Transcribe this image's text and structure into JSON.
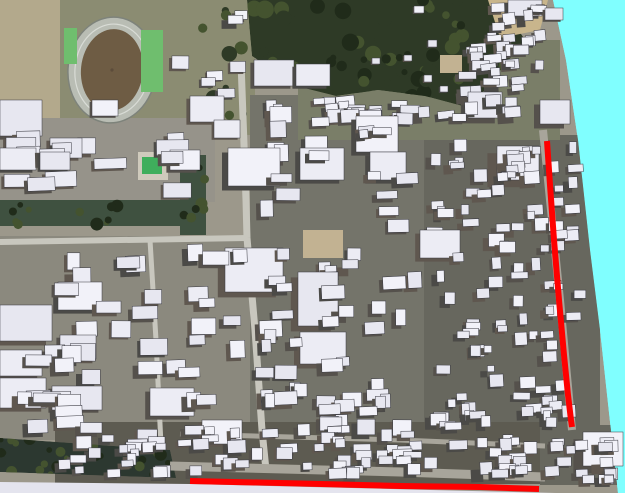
{
  "scene": {
    "width": 625,
    "height": 493,
    "seed": 11,
    "colors": {
      "sky": "#80FFFF",
      "groundBase": "#9C988B",
      "tanZone": "#B3A98C",
      "parkOlive": "#8B8C72",
      "leftTopGround": "#96938A",
      "leftGround": "#8B897E",
      "denseGround": "#74746A",
      "denseGround2": "#67675E",
      "neGround": "#7A7E68",
      "bottomGround": "#5D5B51",
      "forest": "#2E3A26",
      "forestLight": "#44532F",
      "forestDark": "#202B1A",
      "canal": "#3F5140",
      "treeBand": "#2C3830",
      "road": "#C8C7BE",
      "roadDark": "#A8A59B",
      "trackGray": "#B9BDB4",
      "trackEdge": "#7E837B",
      "laneWhite": "#D9DCD6",
      "infield": "#6E5C44",
      "infieldDot": "#5C4C3B",
      "courtGreen": "#6FBE6E",
      "poolGreen": "#3FAE5C",
      "poolDeck": "#CFCABC",
      "tanLot": "#C2B292",
      "tanCorner": "#C8B58C",
      "skirt": "#E4E4EE",
      "outline": "#383840",
      "roofTints": [
        "#ECECF4",
        "#E7E7F0",
        "#F2F2F9"
      ],
      "sideTints": [
        "#55514C",
        "#4B4A47",
        "#5F574F"
      ]
    },
    "terrain": {
      "polygon": [
        [
          0,
          0
        ],
        [
          553,
          0
        ],
        [
          566,
          60
        ],
        [
          578,
          140
        ],
        [
          590,
          250
        ],
        [
          600,
          330
        ],
        [
          612,
          440
        ],
        [
          618,
          493
        ],
        [
          0,
          493
        ]
      ]
    },
    "skirt": {
      "polygon": [
        [
          0,
          482
        ],
        [
          190,
          484
        ],
        [
          430,
          490
        ],
        [
          556,
          493
        ],
        [
          0,
          493
        ]
      ]
    },
    "grounds": [
      [
        0,
        0,
        66,
        140,
        "tanZone"
      ],
      [
        60,
        0,
        195,
        135,
        "parkOlive"
      ],
      [
        0,
        118,
        215,
        84,
        "leftTopGround"
      ],
      [
        0,
        236,
        252,
        204,
        "leftGround"
      ],
      [
        250,
        95,
        175,
        350,
        "denseGround"
      ],
      [
        424,
        135,
        176,
        300,
        "denseGround2"
      ],
      [
        298,
        40,
        262,
        100,
        "neGround"
      ],
      [
        55,
        422,
        500,
        62,
        "bottomGround"
      ],
      [
        540,
        425,
        85,
        60,
        "denseGround2"
      ]
    ],
    "forest": {
      "polygon": [
        [
          247,
          0
        ],
        [
          498,
          0
        ],
        [
          525,
          40
        ],
        [
          470,
          108
        ],
        [
          425,
          96
        ],
        [
          378,
          90
        ],
        [
          336,
          96
        ],
        [
          296,
          86
        ],
        [
          252,
          56
        ]
      ],
      "scatter": 70
    },
    "canal": {
      "rects": [
        [
          0,
          200,
          205,
          26
        ],
        [
          180,
          155,
          26,
          80
        ]
      ],
      "scatter": 20
    },
    "park_trees": {
      "region": [
        165,
        0,
        85,
        125
      ],
      "scatter": 10
    },
    "stadium": {
      "cx": 112,
      "cy": 70,
      "rx": 44,
      "ry": 53,
      "rotation": 6
    },
    "courts": [
      [
        141,
        30,
        22,
        62
      ],
      [
        64,
        28,
        13,
        36
      ]
    ],
    "pool": {
      "deck": [
        138,
        152,
        30,
        28
      ],
      "water": [
        142,
        157,
        20,
        17
      ]
    },
    "tan_lots": [
      [
        303,
        230,
        40,
        28
      ],
      [
        440,
        55,
        22,
        18
      ]
    ],
    "tan_corner": {
      "polygon": [
        [
          488,
          0
        ],
        [
          548,
          0
        ],
        [
          540,
          30
        ],
        [
          500,
          38
        ]
      ]
    },
    "tree_band": {
      "polygon": [
        [
          0,
          438
        ],
        [
          170,
          450
        ],
        [
          176,
          478
        ],
        [
          0,
          472
        ]
      ],
      "scatter": 26
    },
    "roads": [
      {
        "points": [
          [
            241,
            62
          ],
          [
            246,
            200
          ],
          [
            247,
            238
          ]
        ],
        "width": 7,
        "color": "road"
      },
      {
        "points": [
          [
            0,
            242
          ],
          [
            247,
            238
          ]
        ],
        "width": 6,
        "color": "road"
      },
      {
        "points": [
          [
            247,
            238
          ],
          [
            255,
            330
          ],
          [
            262,
            430
          ],
          [
            266,
            470
          ]
        ],
        "width": 7,
        "color": "road"
      },
      {
        "points": [
          [
            150,
            240
          ],
          [
            156,
            340
          ],
          [
            161,
            445
          ]
        ],
        "width": 5,
        "color": "road"
      },
      {
        "points": [
          [
            180,
            434
          ],
          [
            400,
            440
          ],
          [
            545,
            446
          ]
        ],
        "width": 5,
        "color": "roadDark"
      },
      {
        "points": [
          [
            170,
            466
          ],
          [
            400,
            472
          ],
          [
            545,
            477
          ]
        ],
        "width": 9,
        "color": "roadDark"
      },
      {
        "points": [
          [
            543,
            130
          ],
          [
            560,
            300
          ],
          [
            572,
            430
          ]
        ],
        "width": 8,
        "color": "roadDark"
      }
    ],
    "districts": [
      {
        "name": "ne-band-west",
        "x": 300,
        "y": 96,
        "w": 160,
        "h": 44,
        "n": 20,
        "w1": 8,
        "w2": 20,
        "h1": 6,
        "h2": 14,
        "e1": 2,
        "e2": 4,
        "rot": 8,
        "edge": false
      },
      {
        "name": "ne-band-east",
        "x": 452,
        "y": 44,
        "w": 104,
        "h": 92,
        "n": 22,
        "w1": 8,
        "w2": 18,
        "h1": 6,
        "h2": 13,
        "e1": 2,
        "e2": 4,
        "rot": 9,
        "edge": true
      },
      {
        "name": "east-column",
        "x": 424,
        "y": 138,
        "w": 162,
        "h": 292,
        "n": 105,
        "w1": 7,
        "w2": 17,
        "h1": 6,
        "h2": 13,
        "e1": 2,
        "e2": 5,
        "rot": 5,
        "edge": true
      },
      {
        "name": "center",
        "x": 252,
        "y": 96,
        "w": 170,
        "h": 344,
        "n": 66,
        "w1": 9,
        "w2": 24,
        "h1": 7,
        "h2": 17,
        "e1": 2,
        "e2": 5,
        "rot": 4,
        "edge": false
      },
      {
        "name": "bottom-band",
        "x": 58,
        "y": 424,
        "w": 484,
        "h": 56,
        "n": 80,
        "w1": 8,
        "w2": 20,
        "h1": 6,
        "h2": 13,
        "e1": 2,
        "e2": 4,
        "rot": 4,
        "edge": false
      },
      {
        "name": "southwest",
        "x": 2,
        "y": 240,
        "w": 246,
        "h": 196,
        "n": 40,
        "w1": 12,
        "w2": 28,
        "h1": 9,
        "h2": 18,
        "e1": 2,
        "e2": 5,
        "rot": 3,
        "edge": false
      },
      {
        "name": "west-mid",
        "x": 0,
        "y": 118,
        "w": 214,
        "h": 82,
        "n": 14,
        "w1": 16,
        "w2": 34,
        "h1": 10,
        "h2": 20,
        "e1": 2,
        "e2": 4,
        "rot": 3,
        "edge": false
      },
      {
        "name": "park-facilities",
        "x": 170,
        "y": 6,
        "w": 78,
        "h": 116,
        "n": 7,
        "w1": 10,
        "w2": 18,
        "h1": 8,
        "h2": 14,
        "e1": 1,
        "e2": 3,
        "rot": 3,
        "edge": false
      },
      {
        "name": "northeast-corner",
        "x": 470,
        "y": 0,
        "w": 86,
        "h": 92,
        "n": 18,
        "w1": 8,
        "w2": 16,
        "h1": 6,
        "h2": 12,
        "e1": 2,
        "e2": 4,
        "rot": 10,
        "edge": true
      },
      {
        "name": "southeast-corner",
        "x": 540,
        "y": 430,
        "w": 82,
        "h": 54,
        "n": 16,
        "w1": 8,
        "w2": 16,
        "h1": 6,
        "h2": 12,
        "e1": 2,
        "e2": 4,
        "rot": 5,
        "edge": true
      }
    ],
    "buildings": [
      [
        0,
        100,
        42,
        36,
        4
      ],
      [
        50,
        138,
        32,
        20,
        3
      ],
      [
        92,
        100,
        26,
        16,
        2
      ],
      [
        190,
        96,
        34,
        26,
        3
      ],
      [
        214,
        120,
        26,
        18,
        2
      ],
      [
        0,
        148,
        36,
        22,
        3
      ],
      [
        40,
        152,
        30,
        18,
        2
      ],
      [
        170,
        150,
        30,
        20,
        3
      ],
      [
        0,
        305,
        52,
        36,
        5
      ],
      [
        58,
        282,
        44,
        28,
        4
      ],
      [
        0,
        350,
        42,
        26,
        4
      ],
      [
        60,
        335,
        36,
        24,
        3
      ],
      [
        0,
        378,
        46,
        30,
        4
      ],
      [
        52,
        386,
        50,
        24,
        3
      ],
      [
        225,
        248,
        58,
        44,
        6
      ],
      [
        298,
        272,
        40,
        54,
        6
      ],
      [
        228,
        148,
        52,
        38,
        5
      ],
      [
        300,
        148,
        44,
        32,
        4
      ],
      [
        356,
        116,
        42,
        36,
        4
      ],
      [
        370,
        152,
        36,
        28,
        4
      ],
      [
        420,
        230,
        40,
        28,
        4
      ],
      [
        300,
        332,
        46,
        32,
        5
      ],
      [
        254,
        60,
        40,
        26,
        3
      ],
      [
        296,
        64,
        34,
        22,
        3
      ],
      [
        497,
        146,
        42,
        34,
        8
      ],
      [
        583,
        432,
        40,
        34,
        8
      ],
      [
        468,
        92,
        34,
        26,
        6
      ],
      [
        540,
        100,
        30,
        24,
        5
      ],
      [
        150,
        388,
        44,
        28,
        4
      ],
      [
        202,
        420,
        40,
        24,
        3
      ],
      [
        372,
        58,
        8,
        6,
        1
      ],
      [
        404,
        55,
        8,
        6,
        1
      ],
      [
        424,
        75,
        8,
        7,
        1
      ],
      [
        428,
        40,
        9,
        7,
        1
      ],
      [
        414,
        6,
        10,
        7,
        1
      ],
      [
        440,
        86,
        8,
        6,
        1
      ],
      [
        508,
        0,
        34,
        16,
        3
      ],
      [
        545,
        8,
        18,
        12,
        2
      ]
    ],
    "building_exclusion_lot": [
      300,
      227,
      46,
      34
    ],
    "route": {
      "color": "#FF0000",
      "width": 6,
      "segments": [
        {
          "name": "vertical",
          "points": [
            [
              547,
              141
            ],
            [
              550,
              185
            ],
            [
              554,
              240
            ],
            [
              559,
              300
            ],
            [
              564,
              355
            ],
            [
              568,
              395
            ],
            [
              571,
              420
            ],
            [
              572,
              427
            ]
          ]
        },
        {
          "name": "horizontal",
          "points": [
            [
              190,
              481
            ],
            [
              280,
              483
            ],
            [
              400,
              486
            ],
            [
              480,
              487
            ],
            [
              539,
              489
            ]
          ]
        }
      ]
    }
  }
}
